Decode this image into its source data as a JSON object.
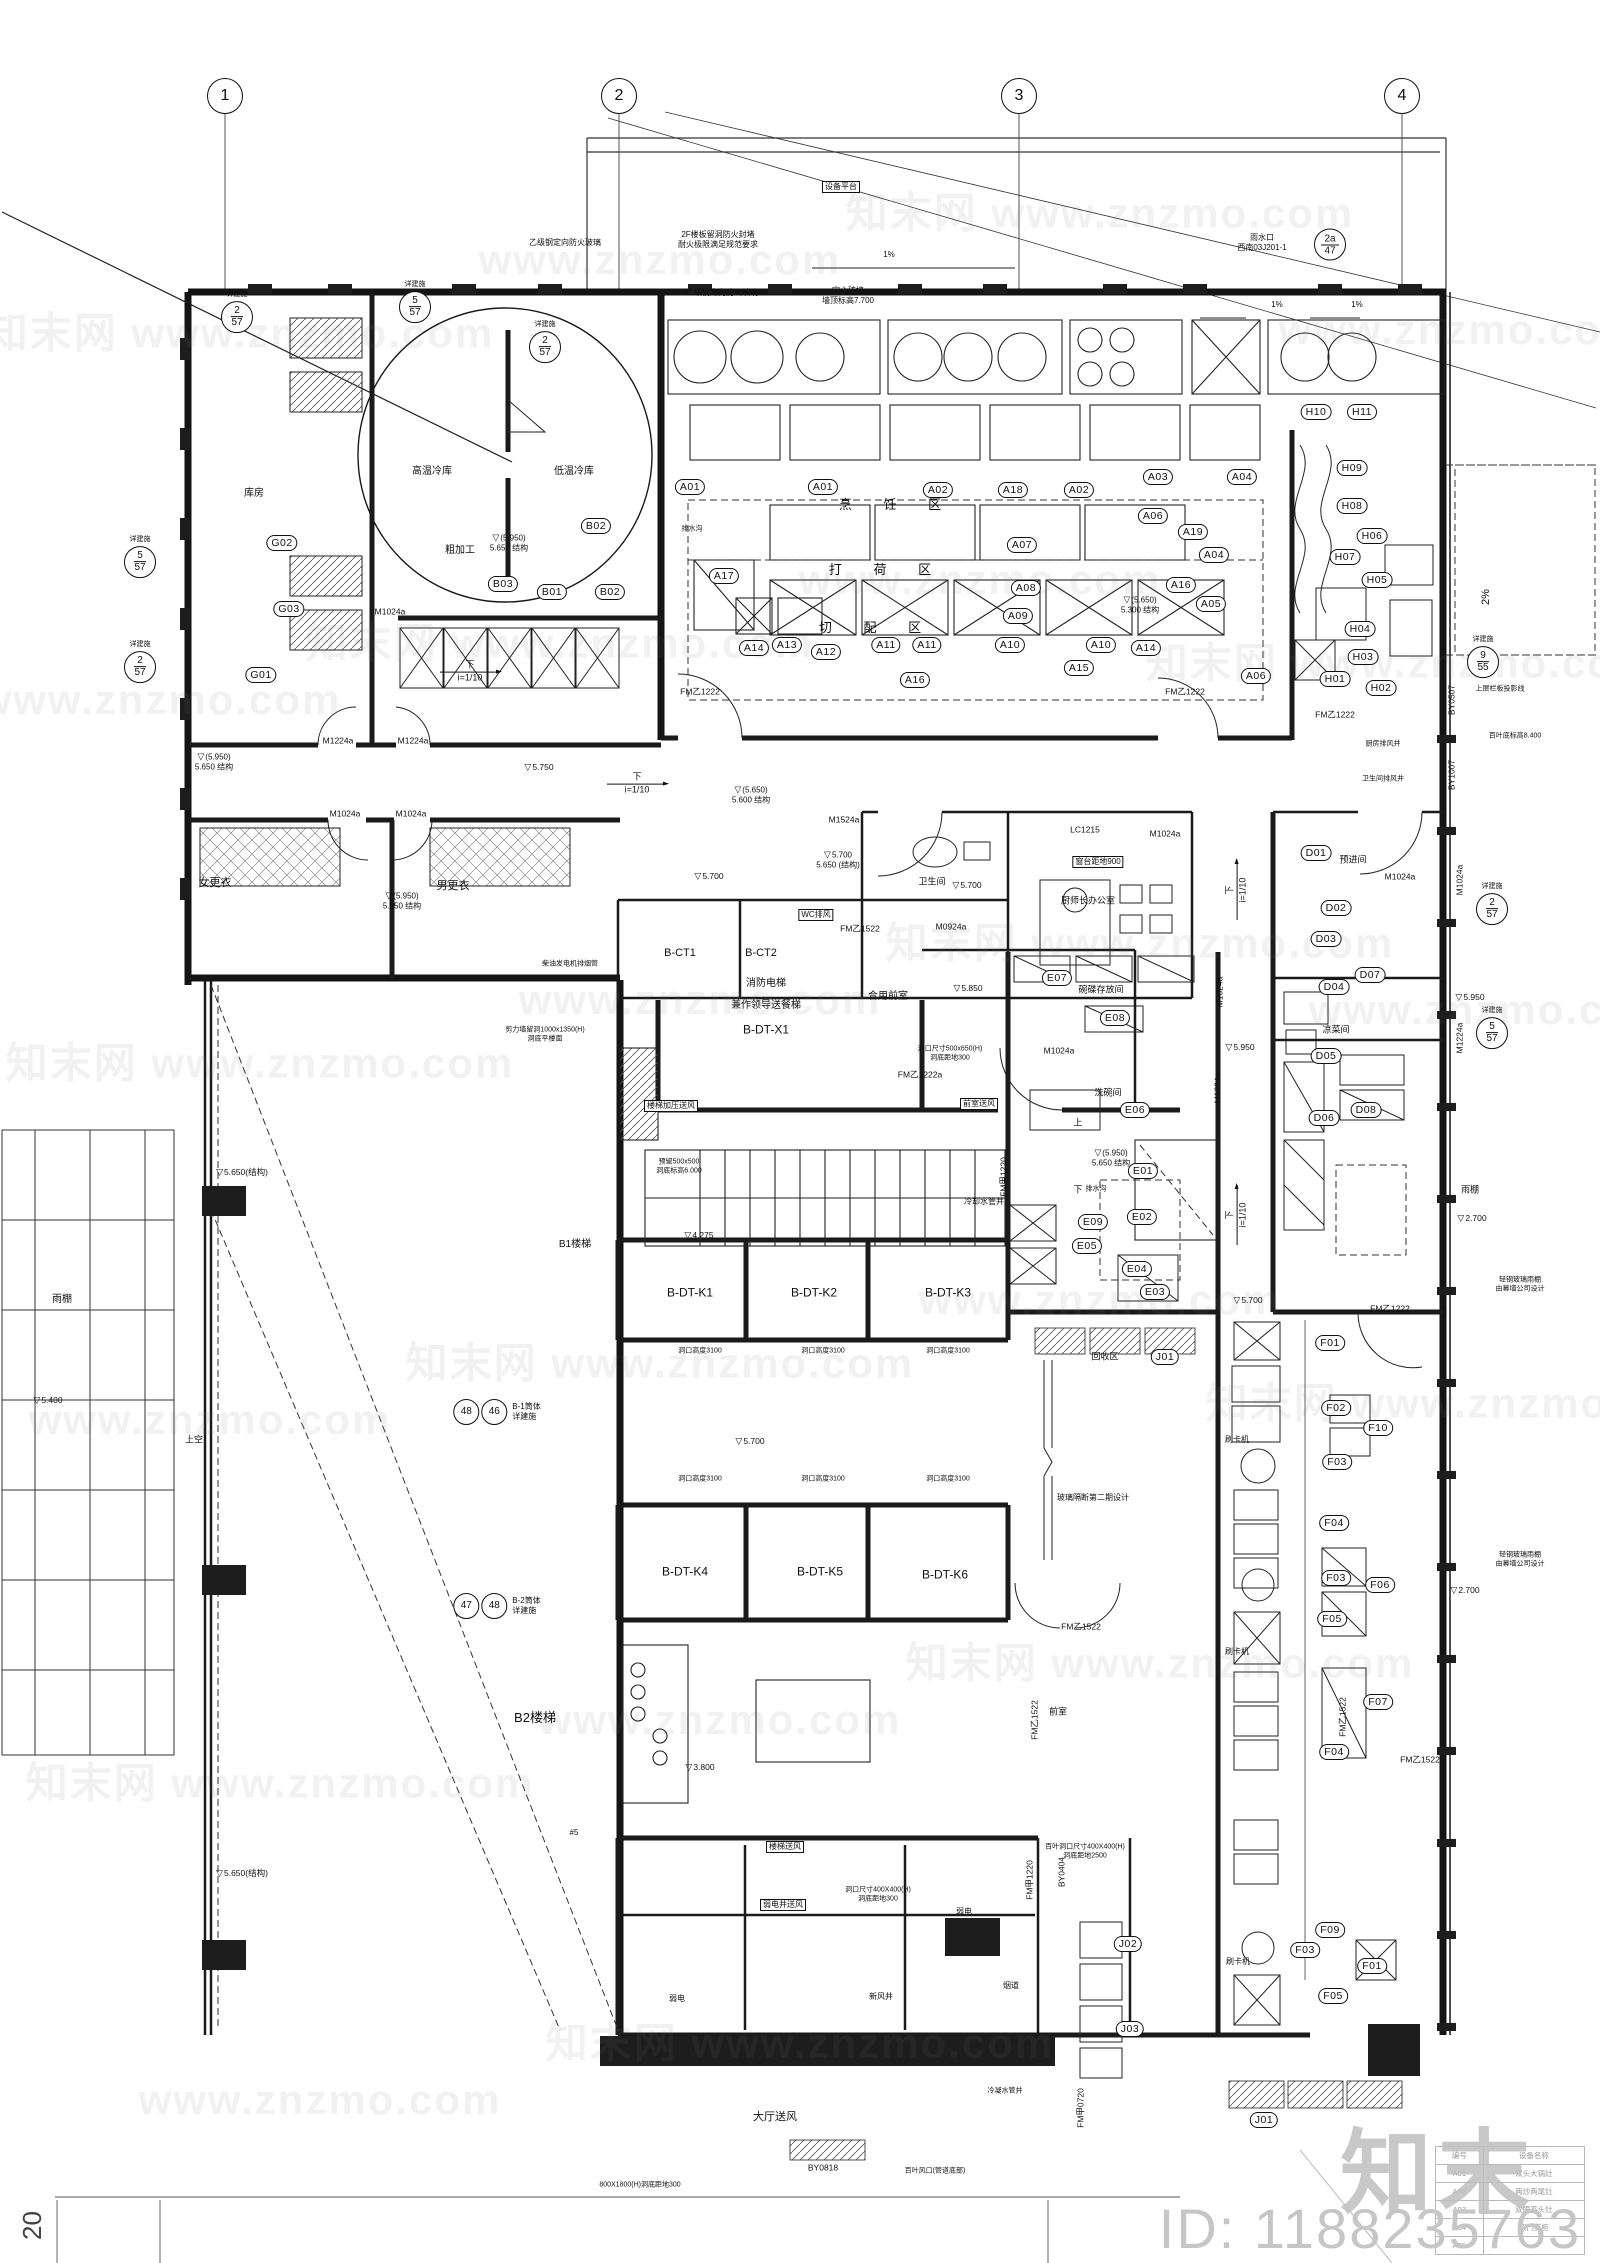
{
  "meta": {
    "id_text": "ID: 1188235763",
    "logo_text": "知末",
    "page_no": "20",
    "watermark_text": "知末网 www.znzmo.com"
  },
  "grid_bubbles": [
    {
      "n": "1",
      "x": 225,
      "y": 96
    },
    {
      "n": "2",
      "x": 619,
      "y": 96
    },
    {
      "n": "3",
      "x": 1019,
      "y": 96
    },
    {
      "n": "4",
      "x": 1402,
      "y": 96
    }
  ],
  "detail_refs": [
    {
      "a": "2",
      "b": "57",
      "note": "详建施",
      "x": 237,
      "y": 312
    },
    {
      "a": "5",
      "b": "57",
      "note": "详建施",
      "x": 415,
      "y": 302
    },
    {
      "a": "2",
      "b": "57",
      "note": "详建施",
      "x": 545,
      "y": 342
    },
    {
      "a": "5",
      "b": "57",
      "note": "详建施",
      "x": 140,
      "y": 557
    },
    {
      "a": "2",
      "b": "57",
      "note": "详建施",
      "x": 140,
      "y": 662
    },
    {
      "a": "2a",
      "b": "47",
      "note": "",
      "x": 1330,
      "y": 244
    },
    {
      "a": "9",
      "b": "55",
      "note": "详建施",
      "x": 1483,
      "y": 657
    },
    {
      "a": "2",
      "b": "57",
      "note": "详建施",
      "x": 1492,
      "y": 904
    },
    {
      "a": "5",
      "b": "57",
      "note": "详建施",
      "x": 1492,
      "y": 1028
    }
  ],
  "pairs": [
    {
      "a": "48",
      "b": "46",
      "t": "B-1筒体\n详建施",
      "x": 497,
      "y": 1412
    },
    {
      "a": "47",
      "b": "48",
      "t": "B-2筒体\n详建施",
      "x": 497,
      "y": 1606
    }
  ],
  "tags": [
    {
      "t": "A01",
      "x": 690,
      "y": 487
    },
    {
      "t": "A01",
      "x": 823,
      "y": 487
    },
    {
      "t": "A02",
      "x": 938,
      "y": 490
    },
    {
      "t": "A18",
      "x": 1013,
      "y": 490
    },
    {
      "t": "A02",
      "x": 1079,
      "y": 490
    },
    {
      "t": "A03",
      "x": 1158,
      "y": 477
    },
    {
      "t": "A04",
      "x": 1242,
      "y": 477
    },
    {
      "t": "A19",
      "x": 1193,
      "y": 532
    },
    {
      "t": "A04",
      "x": 1214,
      "y": 555
    },
    {
      "t": "A05",
      "x": 1211,
      "y": 604
    },
    {
      "t": "A16",
      "x": 1181,
      "y": 585
    },
    {
      "t": "A07",
      "x": 1022,
      "y": 545
    },
    {
      "t": "A08",
      "x": 1026,
      "y": 588
    },
    {
      "t": "A09",
      "x": 1018,
      "y": 616
    },
    {
      "t": "A06",
      "x": 1153,
      "y": 516
    },
    {
      "t": "A17",
      "x": 724,
      "y": 576
    },
    {
      "t": "A16",
      "x": 915,
      "y": 680
    },
    {
      "t": "A06",
      "x": 1256,
      "y": 676
    },
    {
      "t": "A14",
      "x": 754,
      "y": 648
    },
    {
      "t": "A13",
      "x": 787,
      "y": 645
    },
    {
      "t": "A12",
      "x": 826,
      "y": 652
    },
    {
      "t": "A11",
      "x": 886,
      "y": 645
    },
    {
      "t": "A11",
      "x": 927,
      "y": 645
    },
    {
      "t": "A10",
      "x": 1010,
      "y": 645
    },
    {
      "t": "A10",
      "x": 1101,
      "y": 645
    },
    {
      "t": "A15",
      "x": 1079,
      "y": 668
    },
    {
      "t": "A14",
      "x": 1146,
      "y": 648
    },
    {
      "t": "H10",
      "x": 1316,
      "y": 412
    },
    {
      "t": "H11",
      "x": 1362,
      "y": 412
    },
    {
      "t": "H09",
      "x": 1352,
      "y": 468
    },
    {
      "t": "H08",
      "x": 1352,
      "y": 506
    },
    {
      "t": "H06",
      "x": 1372,
      "y": 536
    },
    {
      "t": "H07",
      "x": 1345,
      "y": 557
    },
    {
      "t": "H05",
      "x": 1377,
      "y": 580
    },
    {
      "t": "H04",
      "x": 1360,
      "y": 629
    },
    {
      "t": "H03",
      "x": 1363,
      "y": 657
    },
    {
      "t": "H01",
      "x": 1335,
      "y": 679
    },
    {
      "t": "H02",
      "x": 1381,
      "y": 688
    },
    {
      "t": "G02",
      "x": 282,
      "y": 543
    },
    {
      "t": "G03",
      "x": 289,
      "y": 609
    },
    {
      "t": "G01",
      "x": 261,
      "y": 675
    },
    {
      "t": "B03",
      "x": 503,
      "y": 584
    },
    {
      "t": "B01",
      "x": 552,
      "y": 592
    },
    {
      "t": "B02",
      "x": 610,
      "y": 592
    },
    {
      "t": "B02",
      "x": 596,
      "y": 526
    },
    {
      "t": "D01",
      "x": 1316,
      "y": 853
    },
    {
      "t": "D02",
      "x": 1336,
      "y": 908
    },
    {
      "t": "D03",
      "x": 1326,
      "y": 939
    },
    {
      "t": "D07",
      "x": 1370,
      "y": 975
    },
    {
      "t": "D04",
      "x": 1334,
      "y": 987
    },
    {
      "t": "D05",
      "x": 1326,
      "y": 1056
    },
    {
      "t": "D08",
      "x": 1366,
      "y": 1110
    },
    {
      "t": "D06",
      "x": 1324,
      "y": 1118
    },
    {
      "t": "E07",
      "x": 1057,
      "y": 978
    },
    {
      "t": "E08",
      "x": 1115,
      "y": 1018
    },
    {
      "t": "E06",
      "x": 1135,
      "y": 1110
    },
    {
      "t": "E01",
      "x": 1143,
      "y": 1171
    },
    {
      "t": "E02",
      "x": 1142,
      "y": 1217
    },
    {
      "t": "E09",
      "x": 1093,
      "y": 1222
    },
    {
      "t": "E05",
      "x": 1087,
      "y": 1246
    },
    {
      "t": "E04",
      "x": 1137,
      "y": 1269
    },
    {
      "t": "E03",
      "x": 1155,
      "y": 1292
    },
    {
      "t": "F01",
      "x": 1330,
      "y": 1343
    },
    {
      "t": "F02",
      "x": 1336,
      "y": 1408
    },
    {
      "t": "F10",
      "x": 1378,
      "y": 1428
    },
    {
      "t": "F03",
      "x": 1337,
      "y": 1462
    },
    {
      "t": "F04",
      "x": 1334,
      "y": 1523
    },
    {
      "t": "F03",
      "x": 1336,
      "y": 1578
    },
    {
      "t": "F06",
      "x": 1380,
      "y": 1585
    },
    {
      "t": "F05",
      "x": 1332,
      "y": 1619
    },
    {
      "t": "F07",
      "x": 1378,
      "y": 1702
    },
    {
      "t": "F04",
      "x": 1334,
      "y": 1752
    },
    {
      "t": "F09",
      "x": 1330,
      "y": 1930
    },
    {
      "t": "F03",
      "x": 1305,
      "y": 1950
    },
    {
      "t": "F01",
      "x": 1372,
      "y": 1966
    },
    {
      "t": "F05",
      "x": 1333,
      "y": 1996
    },
    {
      "t": "J01",
      "x": 1165,
      "y": 1357
    },
    {
      "t": "J01",
      "x": 1264,
      "y": 2120
    },
    {
      "t": "J02",
      "x": 1128,
      "y": 1944
    },
    {
      "t": "J03",
      "x": 1130,
      "y": 2029
    }
  ],
  "zones": [
    {
      "t": "烹 饪 区",
      "x": 890,
      "y": 505
    },
    {
      "t": "打 荷 区",
      "x": 880,
      "y": 570
    },
    {
      "t": "切 配 区",
      "x": 870,
      "y": 628
    }
  ],
  "rooms": [
    {
      "t": "高温冷库",
      "x": 432,
      "y": 472,
      "fs": 10
    },
    {
      "t": "低温冷库",
      "x": 574,
      "y": 472,
      "fs": 10
    },
    {
      "t": "库房",
      "x": 254,
      "y": 494,
      "fs": 10
    },
    {
      "t": "粗加工",
      "x": 460,
      "y": 551,
      "fs": 10
    },
    {
      "t": "女更衣",
      "x": 215,
      "y": 884,
      "fs": 11
    },
    {
      "t": "男更衣",
      "x": 453,
      "y": 887,
      "fs": 11
    },
    {
      "t": "卫生间",
      "x": 932,
      "y": 882,
      "fs": 9
    },
    {
      "t": "厨师长办公室",
      "x": 1088,
      "y": 901,
      "fs": 9
    },
    {
      "t": "B-CT1",
      "x": 680,
      "y": 954,
      "fs": 11
    },
    {
      "t": "B-CT2",
      "x": 761,
      "y": 954,
      "fs": 11
    },
    {
      "t": "消防电梯",
      "x": 766,
      "y": 984,
      "fs": 10
    },
    {
      "t": "兼作领导送餐梯",
      "x": 766,
      "y": 1006,
      "fs": 10
    },
    {
      "t": "B-DT-X1",
      "x": 766,
      "y": 1030,
      "fs": 12
    },
    {
      "t": "合用前室",
      "x": 888,
      "y": 997,
      "fs": 10
    },
    {
      "t": "碗碟存放间",
      "x": 1101,
      "y": 990,
      "fs": 9
    },
    {
      "t": "洗碗间",
      "x": 1108,
      "y": 1093,
      "fs": 9
    },
    {
      "t": "凉菜间",
      "x": 1336,
      "y": 1030,
      "fs": 9
    },
    {
      "t": "预进间",
      "x": 1353,
      "y": 860,
      "fs": 9
    },
    {
      "t": "冷却水管井",
      "x": 984,
      "y": 1202,
      "fs": 8
    },
    {
      "t": "上",
      "x": 1078,
      "y": 1123,
      "fs": 9
    },
    {
      "t": "下",
      "x": 1078,
      "y": 1190,
      "fs": 9
    },
    {
      "t": "B1楼梯",
      "x": 575,
      "y": 1245,
      "fs": 10
    },
    {
      "t": "B-DT-K1",
      "x": 690,
      "y": 1293,
      "fs": 12
    },
    {
      "t": "B-DT-K2",
      "x": 814,
      "y": 1293,
      "fs": 12
    },
    {
      "t": "B-DT-K3",
      "x": 948,
      "y": 1293,
      "fs": 12
    },
    {
      "t": "回收区",
      "x": 1105,
      "y": 1357,
      "fs": 9
    },
    {
      "t": "B-DT-K4",
      "x": 685,
      "y": 1572,
      "fs": 12
    },
    {
      "t": "B-DT-K5",
      "x": 820,
      "y": 1572,
      "fs": 12
    },
    {
      "t": "B-DT-K6",
      "x": 945,
      "y": 1575,
      "fs": 12
    },
    {
      "t": "B2楼梯",
      "x": 535,
      "y": 1718,
      "fs": 13
    },
    {
      "t": "前室",
      "x": 1058,
      "y": 1712,
      "fs": 9
    },
    {
      "t": "弱电",
      "x": 964,
      "y": 1912,
      "fs": 8
    },
    {
      "t": "弱电",
      "x": 677,
      "y": 1999,
      "fs": 8
    },
    {
      "t": "新风井",
      "x": 881,
      "y": 1997,
      "fs": 8
    },
    {
      "t": "烟道",
      "x": 1011,
      "y": 1986,
      "fs": 8
    },
    {
      "t": "冷凝水管井",
      "x": 1005,
      "y": 2092,
      "fs": 7
    },
    {
      "t": "刷卡机",
      "x": 1237,
      "y": 1440,
      "fs": 8
    },
    {
      "t": "刷卡机",
      "x": 1237,
      "y": 1652,
      "fs": 8
    },
    {
      "t": "刷卡机",
      "x": 1238,
      "y": 1962,
      "fs": 8
    },
    {
      "t": "大厅送风",
      "x": 775,
      "y": 2118,
      "fs": 11
    },
    {
      "t": "雨棚",
      "x": 62,
      "y": 1300,
      "fs": 10
    },
    {
      "t": "雨棚",
      "x": 1470,
      "y": 1190,
      "fs": 9
    },
    {
      "t": "上空",
      "x": 194,
      "y": 1440,
      "fs": 9
    },
    {
      "t": "#5",
      "x": 574,
      "y": 1833,
      "fs": 8
    }
  ],
  "codes": [
    {
      "t": "M1024a",
      "x": 390,
      "y": 612
    },
    {
      "t": "M1224a",
      "x": 338,
      "y": 741
    },
    {
      "t": "M1224a",
      "x": 413,
      "y": 741
    },
    {
      "t": "M1024a",
      "x": 345,
      "y": 814
    },
    {
      "t": "M1024a",
      "x": 411,
      "y": 814
    },
    {
      "t": "M1524a",
      "x": 844,
      "y": 820
    },
    {
      "t": "M0924a",
      "x": 951,
      "y": 927
    },
    {
      "t": "LC1215",
      "x": 1085,
      "y": 830
    },
    {
      "t": "M1024a",
      "x": 1165,
      "y": 834
    },
    {
      "t": "M1024a",
      "x": 1400,
      "y": 877
    },
    {
      "t": "M1024a",
      "x": 1059,
      "y": 1051
    },
    {
      "t": "FM乙1222",
      "x": 700,
      "y": 692
    },
    {
      "t": "FM乙1222",
      "x": 1185,
      "y": 692
    },
    {
      "t": "FM乙1222",
      "x": 1335,
      "y": 715
    },
    {
      "t": "FM乙1222",
      "x": 1390,
      "y": 1309
    },
    {
      "t": "FM乙1222a",
      "x": 920,
      "y": 1075
    },
    {
      "t": "FM乙1522",
      "x": 860,
      "y": 929
    },
    {
      "t": "FM乙1522",
      "x": 1081,
      "y": 1627
    },
    {
      "t": "FM乙1522",
      "x": 1420,
      "y": 1760
    },
    {
      "t": "BY0818",
      "x": 823,
      "y": 2168
    },
    {
      "t": "M1024a",
      "x": 1460,
      "y": 880,
      "rot": -90
    },
    {
      "t": "M1224a",
      "x": 1460,
      "y": 1038,
      "rot": -90
    },
    {
      "t": "M1024a",
      "x": 1220,
      "y": 992,
      "rot": -90
    },
    {
      "t": "M1224a",
      "x": 1218,
      "y": 1088,
      "rot": -90
    },
    {
      "t": "FM甲1220",
      "x": 1004,
      "y": 1177,
      "rot": -90
    },
    {
      "t": "FM甲1220",
      "x": 1030,
      "y": 1880,
      "rot": -90
    },
    {
      "t": "FM甲0720",
      "x": 1081,
      "y": 2108,
      "rot": -90
    },
    {
      "t": "BY0507",
      "x": 1452,
      "y": 700,
      "rot": -90
    },
    {
      "t": "BY1007",
      "x": 1452,
      "y": 775,
      "rot": -90
    },
    {
      "t": "BY0404",
      "x": 1062,
      "y": 1872,
      "rot": -90
    },
    {
      "t": "FM乙1522",
      "x": 1343,
      "y": 1717,
      "rot": -90
    },
    {
      "t": "FM乙1522",
      "x": 1035,
      "y": 1720,
      "rot": -90
    }
  ],
  "levels": [
    {
      "t": "5.750",
      "x": 539,
      "y": 762
    },
    {
      "t": "5.700",
      "x": 709,
      "y": 871
    },
    {
      "t": "5.700",
      "x": 967,
      "y": 880
    },
    {
      "t": "5.850",
      "x": 968,
      "y": 983
    },
    {
      "t": "5.950",
      "x": 1240,
      "y": 1042
    },
    {
      "t": "5.950",
      "x": 1470,
      "y": 992
    },
    {
      "t": "5.700",
      "x": 750,
      "y": 1436
    },
    {
      "t": "5.700",
      "x": 1248,
      "y": 1295
    },
    {
      "t": "4.275",
      "x": 699,
      "y": 1230
    },
    {
      "t": "3.800",
      "x": 700,
      "y": 1762
    },
    {
      "t": "2.700",
      "x": 1472,
      "y": 1213
    },
    {
      "t": "2.700",
      "x": 1465,
      "y": 1585
    },
    {
      "t": "5.400",
      "x": 48,
      "y": 1395
    },
    {
      "t": "5.650(结构)",
      "x": 242,
      "y": 1167
    },
    {
      "t": "5.650(结构)",
      "x": 242,
      "y": 1868
    },
    {
      "t": "(5.950)\n5.650 结构",
      "x": 509,
      "y": 538,
      "cls": "lvl2"
    },
    {
      "t": "(5.950)\n5.650 结构",
      "x": 214,
      "y": 757,
      "cls": "lvl2"
    },
    {
      "t": "(5.950)\n5.650 结构",
      "x": 402,
      "y": 896,
      "cls": "lvl2"
    },
    {
      "t": "(5.950)\n5.650 结构",
      "x": 1111,
      "y": 1153,
      "cls": "lvl2"
    },
    {
      "t": "(5.650)\n5.600 结构",
      "x": 751,
      "y": 790,
      "cls": "lvl2"
    },
    {
      "t": "(5.650)\n5.300 结构",
      "x": 1140,
      "y": 600,
      "cls": "lvl2"
    },
    {
      "t": "5.700\n5.650 (结构)",
      "x": 838,
      "y": 855,
      "cls": "lvl2"
    }
  ],
  "notes": [
    {
      "t": "乙级钢定向防火玻璃",
      "x": 565,
      "y": 243
    },
    {
      "t": "2F楼板留洞防火封堵\n耐火极限满足规范要求",
      "x": 718,
      "y": 240
    },
    {
      "t": "乙级钢定向防火玻璃",
      "x": 722,
      "y": 293
    },
    {
      "t": "空心砖墙\n墙顶标高7.700",
      "x": 848,
      "y": 296
    },
    {
      "t": "雨水口\n西南03J201-1",
      "x": 1262,
      "y": 243
    },
    {
      "t": "1%",
      "x": 889,
      "y": 255
    },
    {
      "t": "1%",
      "x": 1277,
      "y": 305
    },
    {
      "t": "1%",
      "x": 1357,
      "y": 305
    },
    {
      "t": "2%",
      "x": 1487,
      "y": 597,
      "rot": -90,
      "fs": 11
    },
    {
      "t": "上层栏板投影线",
      "x": 1500,
      "y": 690,
      "fs": 7
    },
    {
      "t": "百叶底标高8.400",
      "x": 1515,
      "y": 737,
      "fs": 7
    },
    {
      "t": "厨房排风井",
      "x": 1383,
      "y": 745,
      "fs": 7
    },
    {
      "t": "卫生间排风井",
      "x": 1383,
      "y": 780,
      "fs": 7
    },
    {
      "t": "排水沟",
      "x": 692,
      "y": 530,
      "fs": 7
    },
    {
      "t": "排水沟",
      "x": 1096,
      "y": 1190,
      "fs": 7
    },
    {
      "t": "洞口尺寸500x650(H)\n洞底距地300",
      "x": 950,
      "y": 1054,
      "fs": 7
    },
    {
      "t": "预留500x500\n洞底标高6.000",
      "x": 679,
      "y": 1167,
      "fs": 7
    },
    {
      "t": "剪力墙留洞1000x1350(H)\n洞底平楼面",
      "x": 545,
      "y": 1035,
      "fs": 7
    },
    {
      "t": "柴油发电机排烟管",
      "x": 570,
      "y": 965,
      "fs": 7
    },
    {
      "t": "洞口高度3100",
      "x": 700,
      "y": 1352,
      "fs": 7
    },
    {
      "t": "洞口高度3100",
      "x": 823,
      "y": 1352,
      "fs": 7
    },
    {
      "t": "洞口高度3100",
      "x": 948,
      "y": 1352,
      "fs": 7
    },
    {
      "t": "洞口高度3100",
      "x": 700,
      "y": 1480,
      "fs": 7
    },
    {
      "t": "洞口高度3100",
      "x": 823,
      "y": 1480,
      "fs": 7
    },
    {
      "t": "洞口高度3100",
      "x": 948,
      "y": 1480,
      "fs": 7
    },
    {
      "t": "玻璃隔断第二期设计",
      "x": 1093,
      "y": 1498,
      "fs": 8
    },
    {
      "t": "洞口尺寸400X400(H)\n洞底距地300",
      "x": 878,
      "y": 1895,
      "fs": 7
    },
    {
      "t": "百叶洞口尺寸400X400(H)\n洞底距地2500",
      "x": 1085,
      "y": 1852,
      "fs": 7
    },
    {
      "t": "800X1800(H)洞底距地300",
      "x": 640,
      "y": 2186,
      "fs": 7
    },
    {
      "t": "百叶风口(管道底部)",
      "x": 935,
      "y": 2172,
      "fs": 7
    },
    {
      "t": "轻钢玻璃雨棚\n由幕墙公司设计",
      "x": 1520,
      "y": 1285,
      "fs": 7
    },
    {
      "t": "轻钢玻璃雨棚\n由幕墙公司设计",
      "x": 1520,
      "y": 1560,
      "fs": 7
    }
  ],
  "boxed": [
    {
      "t": "设备平台",
      "x": 841,
      "y": 187
    },
    {
      "t": "窗台距地900",
      "x": 1098,
      "y": 862
    },
    {
      "t": "WC排风",
      "x": 816,
      "y": 915
    },
    {
      "t": "楼梯加压送风",
      "x": 671,
      "y": 1106
    },
    {
      "t": "前室送风",
      "x": 979,
      "y": 1104
    },
    {
      "t": "楼梯送风",
      "x": 785,
      "y": 1847
    },
    {
      "t": "弱电井送风",
      "x": 783,
      "y": 1905
    }
  ],
  "ramps": [
    {
      "t": "下",
      "s": "i=1/10",
      "x": 470,
      "y": 672
    },
    {
      "t": "下",
      "s": "i=1/10",
      "x": 637,
      "y": 784
    },
    {
      "t": "下",
      "s": "i=1/10",
      "x": 1237,
      "y": 890,
      "rot": -90
    },
    {
      "t": "下",
      "s": "i=1/10",
      "x": 1237,
      "y": 1215,
      "rot": -90
    }
  ],
  "watermarks": [
    {
      "t": "知末网 www.znzmo.com",
      "x": 240,
      "y": 330
    },
    {
      "t": "www.znzmo.com",
      "x": 660,
      "y": 260
    },
    {
      "t": "知末网 www.znzmo.com",
      "x": 1100,
      "y": 210
    },
    {
      "t": "www.znzmo.com",
      "x": 1460,
      "y": 330
    },
    {
      "t": "www.znzmo.com",
      "x": 160,
      "y": 700
    },
    {
      "t": "知末网 www.znzmo.com",
      "x": 560,
      "y": 640
    },
    {
      "t": "www.znzmo.com",
      "x": 980,
      "y": 580
    },
    {
      "t": "知末网 www.znzmo.com",
      "x": 1400,
      "y": 660
    },
    {
      "t": "知末网 www.znzmo.com",
      "x": 260,
      "y": 1060
    },
    {
      "t": "www.znzmo.com",
      "x": 700,
      "y": 1000
    },
    {
      "t": "知末网 www.znzmo.com",
      "x": 1140,
      "y": 940
    },
    {
      "t": "www.znzmo.com",
      "x": 1490,
      "y": 1010
    },
    {
      "t": "www.znzmo.com",
      "x": 210,
      "y": 1420
    },
    {
      "t": "知末网 www.znzmo.com",
      "x": 660,
      "y": 1360
    },
    {
      "t": "www.znzmo.com",
      "x": 1100,
      "y": 1300
    },
    {
      "t": "知末网 www.znzmo.com",
      "x": 1460,
      "y": 1400
    },
    {
      "t": "知末网 www.znzmo.com",
      "x": 280,
      "y": 1780
    },
    {
      "t": "www.znzmo.com",
      "x": 720,
      "y": 1720
    },
    {
      "t": "知末网 www.znzmo.com",
      "x": 1160,
      "y": 1660
    },
    {
      "t": "www.znzmo.com",
      "x": 320,
      "y": 2100
    },
    {
      "t": "知末网 www.znzmo.com",
      "x": 800,
      "y": 2040
    }
  ],
  "table": {
    "header": "设备名称",
    "rows": [
      [
        "A01",
        "双头大锅灶"
      ],
      [
        "A02",
        "两炒两尾灶"
      ],
      [
        "A03",
        "双眼平头灶"
      ],
      [
        "A04",
        "双门蒸柜"
      ],
      [
        "A05",
        ""
      ]
    ]
  }
}
